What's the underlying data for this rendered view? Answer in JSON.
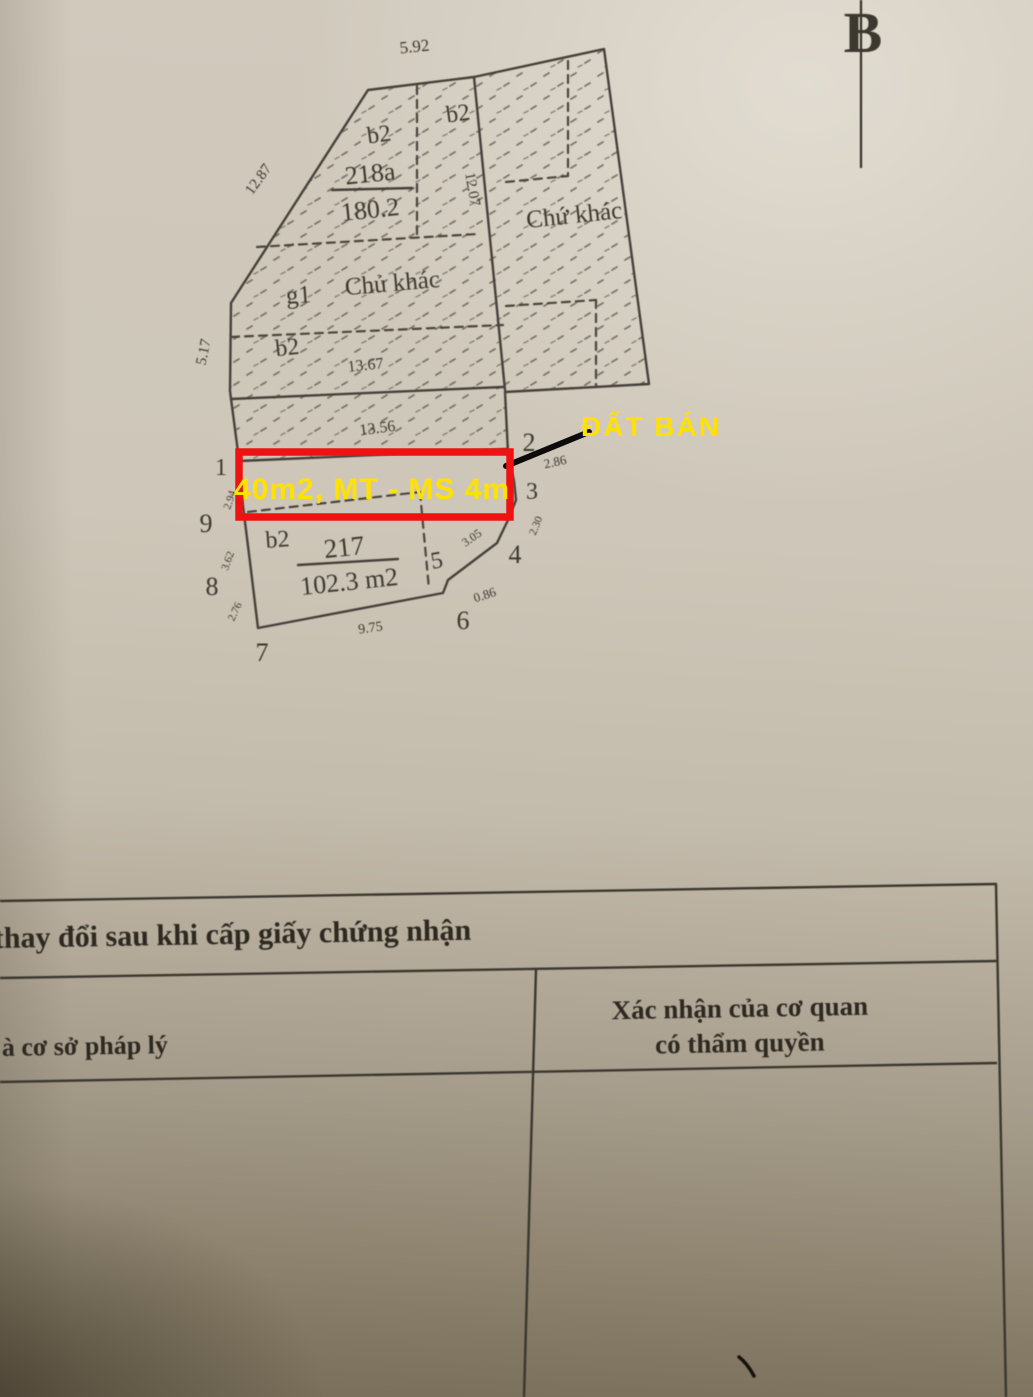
{
  "map": {
    "north": "B",
    "dims": {
      "top": "5.92",
      "slant": "12.87",
      "left": "5.17",
      "vertical": "12.07",
      "mid_upper": "13.67",
      "mid_lower": "13.56",
      "bottom": "9.75",
      "e23": "2.86",
      "e34": "2.30",
      "e45": "3.05",
      "e56": "0.86",
      "e19": "2.94",
      "e98": "3.62",
      "e87": "2.76"
    },
    "parcels": {
      "p218a": {
        "type": "b2",
        "no": "218a",
        "area": "180.2"
      },
      "ptop": {
        "type": "b2"
      },
      "pright": {
        "owner": "Chứ khác"
      },
      "pmid": {
        "type": "g1",
        "owner": "Chủ khác"
      },
      "pleft": {
        "type": "b2"
      },
      "p217": {
        "type": "b2",
        "no": "217",
        "area": "102.3 m2"
      }
    },
    "vertices": {
      "v1": "1",
      "v2": "2",
      "v3": "3",
      "v4": "4",
      "v5": "5",
      "v6": "6",
      "v7": "7",
      "v8": "8",
      "v9": "9"
    }
  },
  "annotations": {
    "highlight_text": "40m2, MT - MS 4m",
    "sale_text": "ĐẤT BÁN",
    "highlight_color": "#ee1312",
    "text_color": "#ffe103",
    "pointer_color": "#0d0c0a"
  },
  "table": {
    "title": "thay đổi sau khi cấp giấy chứng nhận",
    "left_header": "à cơ sở pháp lý",
    "right_header_line1": "Xác nhận của cơ quan",
    "right_header_line2": "có thẩm quyền"
  }
}
